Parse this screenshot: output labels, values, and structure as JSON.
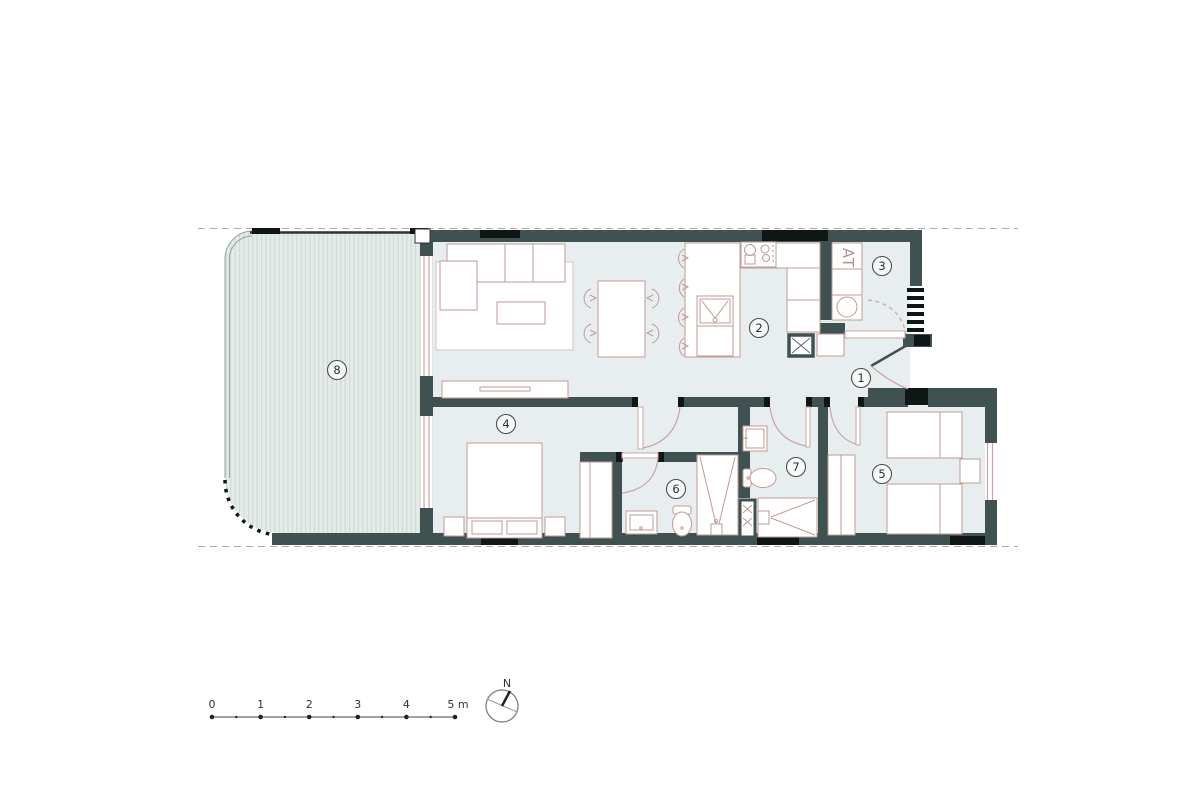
{
  "plan": {
    "room_numbers": [
      "1",
      "2",
      "3",
      "4",
      "5",
      "6",
      "7",
      "8"
    ],
    "utility_label": "AT"
  },
  "scale_bar": {
    "tick_labels": [
      "0",
      "1",
      "2",
      "3",
      "4",
      "5 m"
    ]
  },
  "compass": {
    "north_label": "N"
  },
  "colors": {
    "wall": "#3f5251",
    "accent_black": "#0e1616",
    "floor": "#e8eeef",
    "terrace_fill": "#e5ebe8",
    "terrace_stripe": "#cbd8d3",
    "furniture_line": "#c09a96",
    "door_arc": "#c9a5a1",
    "boundary_dash": "#b5a6a3",
    "label_text": "#2f2f2f"
  }
}
